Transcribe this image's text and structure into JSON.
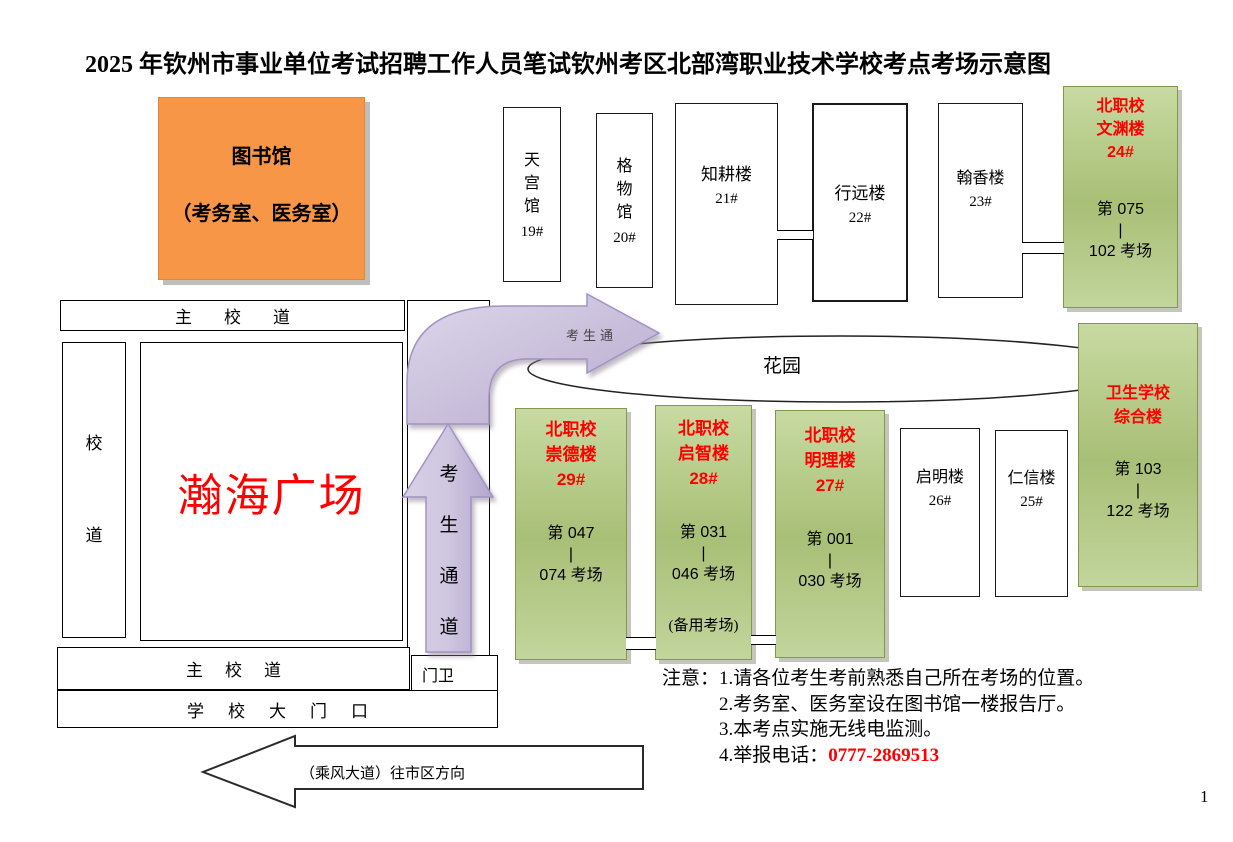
{
  "meta": {
    "title_part1": "2025 年钦州市事业单位考试招聘工作人员笔试",
    "title_part2": "钦州考区北部湾职业技术学校考点考场示意图",
    "page_number": "1"
  },
  "library": {
    "name": "图书馆",
    "subtitle": "（考务室、医务室）"
  },
  "halls": {
    "tiangong": {
      "name": "天宫馆",
      "no": "19#"
    },
    "gewu": {
      "name": "格物馆",
      "no": "20#"
    },
    "zhigeng": {
      "name": "知耕楼",
      "no": "21#"
    },
    "xingyuan": {
      "name": "行远楼",
      "no": "22#"
    },
    "hanxiang": {
      "name": "翰香楼",
      "no": "23#"
    },
    "qiming": {
      "name": "启明楼",
      "no": "26#"
    },
    "renxin": {
      "name": "仁信楼",
      "no": "25#"
    }
  },
  "exam_halls": {
    "wenyuan": {
      "school": "北职校",
      "name": "文渊楼",
      "no": "24#",
      "range_from": "第 075",
      "range_sep": "|",
      "range_to": "102 考场"
    },
    "chongde": {
      "school": "北职校",
      "name": "崇德楼",
      "no": "29#",
      "range_from": "第 047",
      "range_sep": "|",
      "range_to": "074 考场"
    },
    "qizhi": {
      "school": "北职校",
      "name": "启智楼",
      "no": "28#",
      "range_from": "第 031",
      "range_sep": "|",
      "range_to": "046 考场",
      "note": "(备用考场)"
    },
    "mingli": {
      "school": "北职校",
      "name": "明理楼",
      "no": "27#",
      "range_from": "第 001",
      "range_sep": "|",
      "range_to": "030 考场"
    },
    "weisheng": {
      "school": "卫生学校",
      "name": "综合楼",
      "range_from": "第 103",
      "range_sep": "|",
      "range_to": "122 考场"
    }
  },
  "map": {
    "main_road_top": "主校道",
    "main_road_bottom": "主校道",
    "side_road": "校道",
    "plaza": "瀚海广场",
    "garden": "花园",
    "corridor": "考生通道",
    "corridor_arrow_label": "考生通",
    "gate_guard": "门卫",
    "school_gate": "学校大门口",
    "direction_arrow": "（乘风大道）往市区方向"
  },
  "notes": {
    "label": "注意：",
    "item1": "1.请各位考生考前熟悉自己所在考场的位置。",
    "item2": "2.考务室、医务室设在图书馆一楼报告厅。",
    "item3": "3.本考点实施无线电监测。",
    "item4": "4.举报电话：",
    "phone": "0777-2869513"
  },
  "colors": {
    "accent_red": "#ff0000",
    "exam_green_light": "#c8daa2",
    "exam_green_dark": "#a8bf76",
    "library_orange": "#f79646",
    "arrow_purple_light": "#d8d1e6",
    "arrow_purple_dark": "#b3a5cc"
  }
}
